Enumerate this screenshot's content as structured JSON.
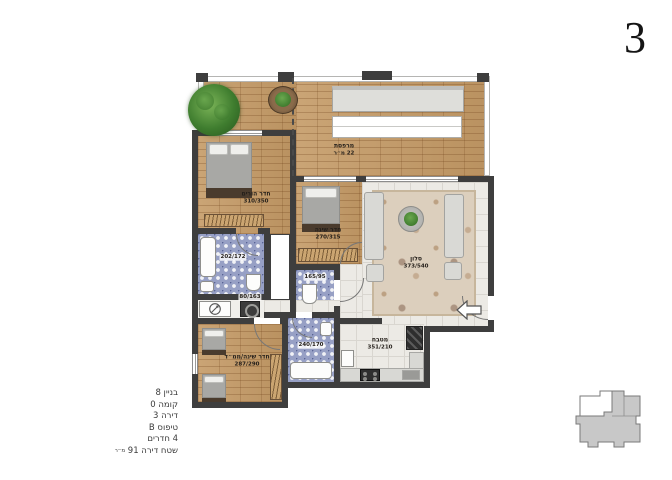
{
  "sheet": {
    "number": "3"
  },
  "apartment_info": {
    "lines": [
      "בניין 8",
      "קומה 0",
      "דירה 3",
      "טיפוס B",
      "4 חדרים"
    ],
    "area_label": "שטח דירה 91",
    "area_unit": "מ״ר"
  },
  "rooms": {
    "balcony": {
      "name": "מרפסת",
      "dims": "22 מ״ר"
    },
    "master_bedroom": {
      "name": "חדר הורים",
      "dims": "310/350"
    },
    "bedroom": {
      "name": "חדר שינה",
      "dims": "270/315"
    },
    "living_room": {
      "name": "סלון",
      "dims": "373/540"
    },
    "kitchen": {
      "name": "מטבח",
      "dims": "351/210"
    },
    "safe_room_bedroom": {
      "name": "חדר שינה/ממ״ד",
      "dims": "287/290"
    },
    "bathroom": {
      "dims": "202/172"
    },
    "toilet": {
      "dims": "165/95"
    },
    "bathroom2": {
      "dims": "240/170"
    },
    "laundry": {
      "dims": "80/163"
    }
  },
  "palette": {
    "wall": "#3e3e3e",
    "wood_floor": "#c49a66",
    "tile_floor": "#eceae5",
    "bath_tile": "#97a0c5",
    "keyplan_fill": "#c8c8c8",
    "highlight_unit": "#ffffff"
  }
}
